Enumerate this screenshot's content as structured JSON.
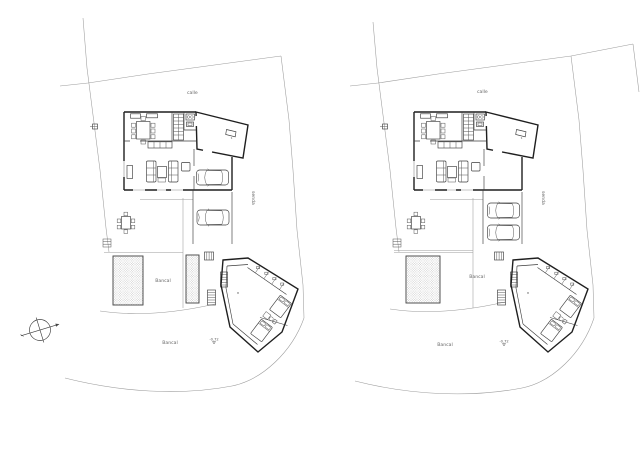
{
  "page": {
    "width": 640,
    "height": 453,
    "background": "#ffffff",
    "description": "Architectural site plan drawing: two nearly identical villa plan variants side by side on a white sheet"
  },
  "colors": {
    "ink": "#1f1f1f",
    "light_line": "#9b9b9b",
    "label_text": "#666666",
    "hatch": "#9a9a9a"
  },
  "compass": {
    "name": "north-arrow"
  },
  "plans": [
    {
      "street_label": "calle",
      "path_label": "senda",
      "upper_terrace_label": "Bancal",
      "lower_terrace_label": "Bancal",
      "level_marker": "-0.72",
      "cars_in_carport": 1,
      "cars_on_drive": 1,
      "hatched_terraces": 2
    },
    {
      "street_label": "calle",
      "path_label": "senda",
      "upper_terrace_label": "Bancal",
      "lower_terrace_label": "Bancal",
      "level_marker": "-0.72",
      "cars_in_carport": 0,
      "cars_on_drive": 2,
      "hatched_terraces": 1
    }
  ]
}
